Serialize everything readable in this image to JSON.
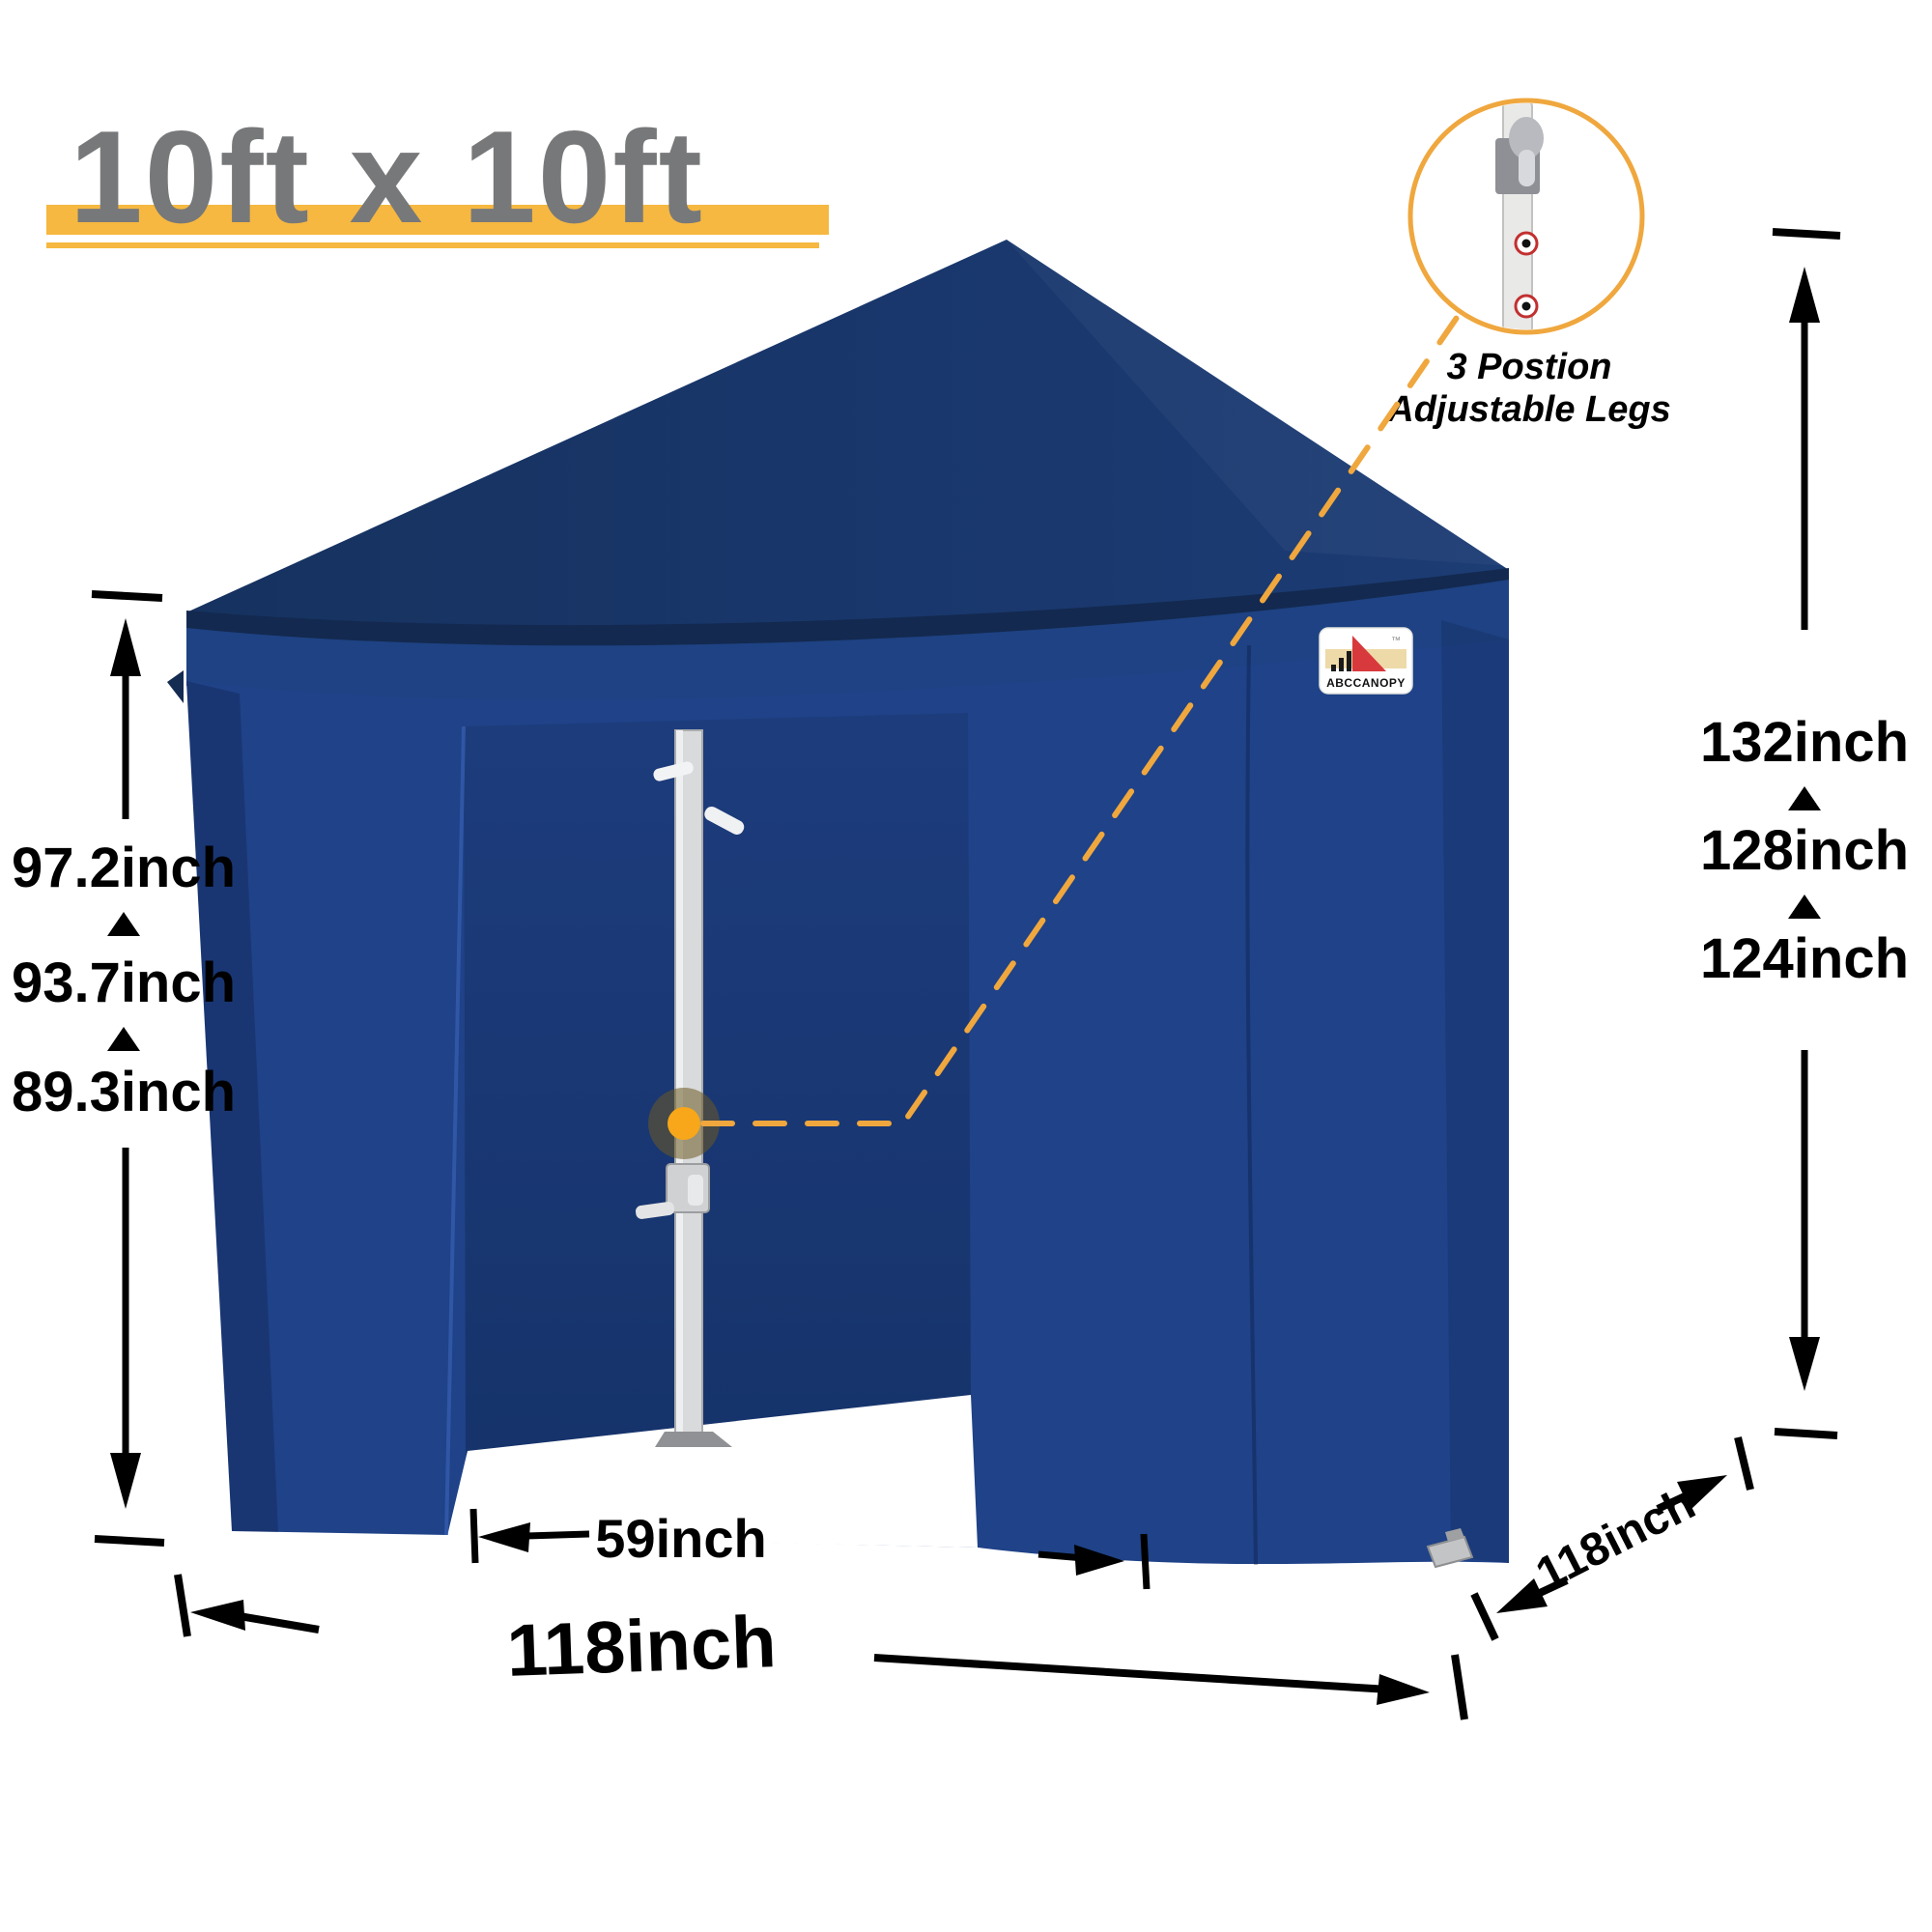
{
  "header": {
    "title": "10ft x 10ft"
  },
  "inset": {
    "caption_line1": "3 Postion",
    "caption_line2": "Adjustable Legs"
  },
  "logo": {
    "brand": "ABCCANOPY",
    "trademark": "™"
  },
  "dimensions": {
    "left_heights": [
      "97.2inch",
      "93.7inch",
      "89.3inch"
    ],
    "right_heights": [
      "132inch",
      "128inch",
      "124inch"
    ],
    "door_width": "59inch",
    "front_width": "118inch",
    "side_depth": "118inch"
  },
  "colors": {
    "accent_yellow": "#F6B840",
    "connector_orange": "#EFA73E",
    "marker_orange": "#F7A719",
    "title_gray": "#77787A",
    "tent_roof": "#19376C",
    "tent_valance": "#1E4283",
    "tent_wall": "#1F4288",
    "tent_interior": "#1D3B78",
    "pole_gray": "#D9DADB",
    "dimension_black": "#000000"
  }
}
